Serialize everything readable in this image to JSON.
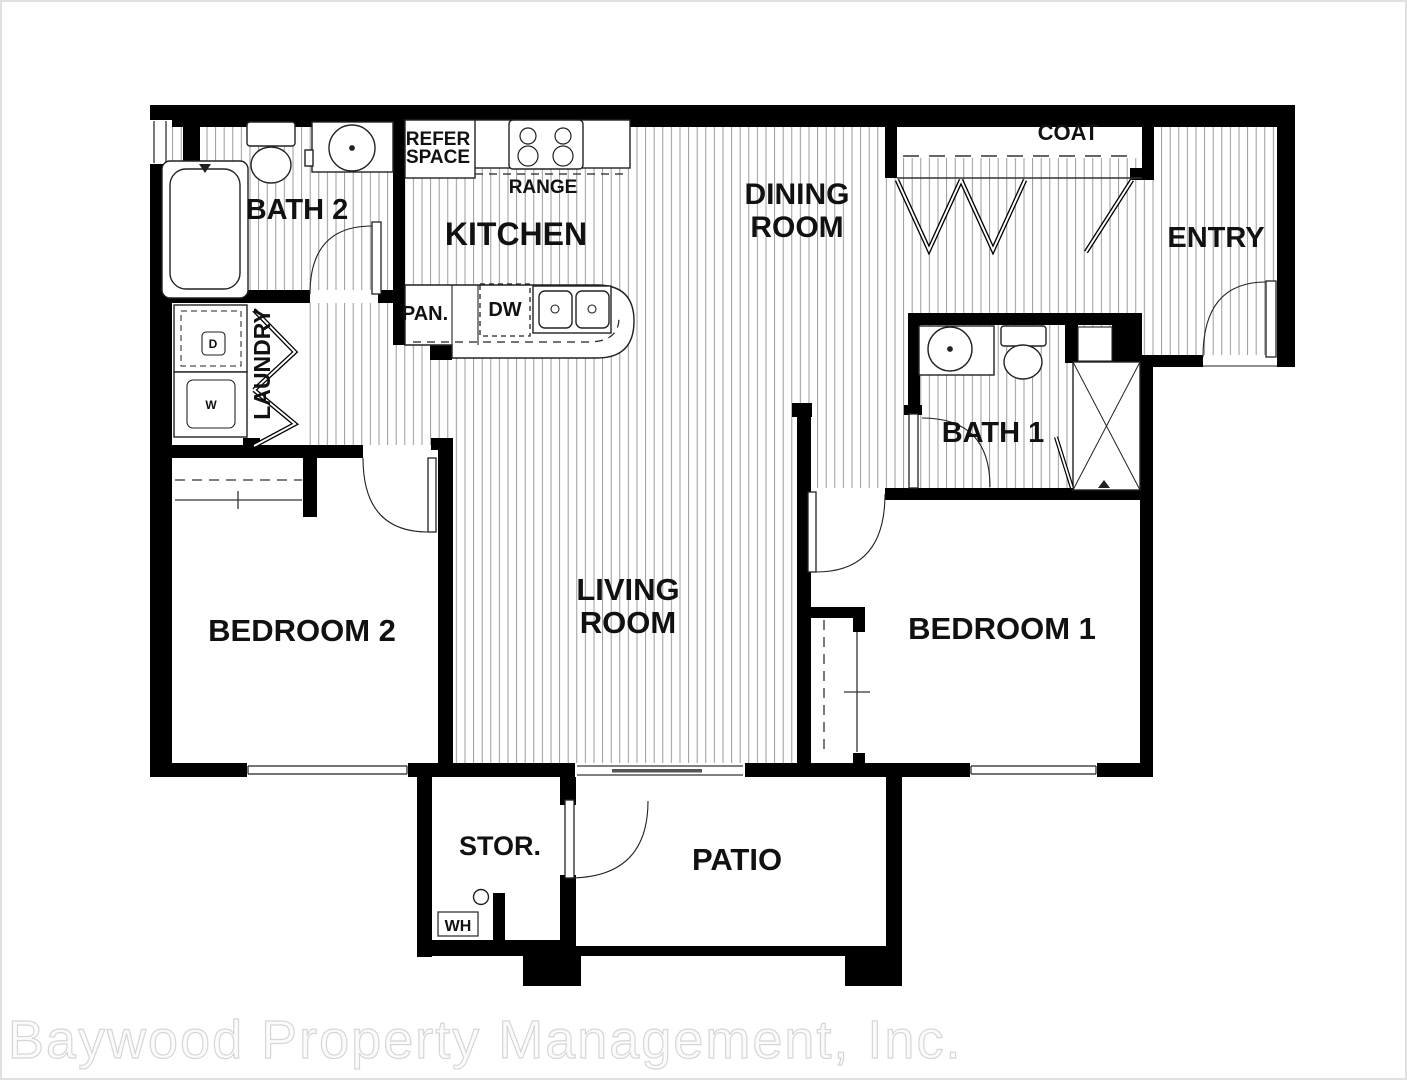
{
  "document": {
    "type": "apartment-floor-plan",
    "background": "#ffffff",
    "border_color": "#e0e0e0"
  },
  "palette": {
    "wall": "#000000",
    "hatch_line": "#8f8f8f",
    "label": "#111111",
    "watermark_fill": "#fbfbfb",
    "watermark_outline": "#d6d6d6"
  },
  "rooms": {
    "bath2": "BATH 2",
    "kitchen": "KITCHEN",
    "dining_line1": "DINING",
    "dining_line2": "ROOM",
    "coat": "COAT",
    "entry": "ENTRY",
    "laundry": "LAUNDRY",
    "bath1": "BATH 1",
    "bedroom2": "BEDROOM 2",
    "living_line1": "LIVING",
    "living_line2": "ROOM",
    "bedroom1": "BEDROOM 1",
    "storage": "STOR.",
    "patio": "PATIO"
  },
  "fixtures": {
    "refer_line1": "REFER",
    "refer_line2": "SPACE",
    "range": "RANGE",
    "pantry": "PAN.",
    "dishwasher": "DW",
    "water_heater": "WH",
    "dryer": "D",
    "washer": "W"
  },
  "watermark": {
    "text": "Baywood Property Management, Inc."
  }
}
